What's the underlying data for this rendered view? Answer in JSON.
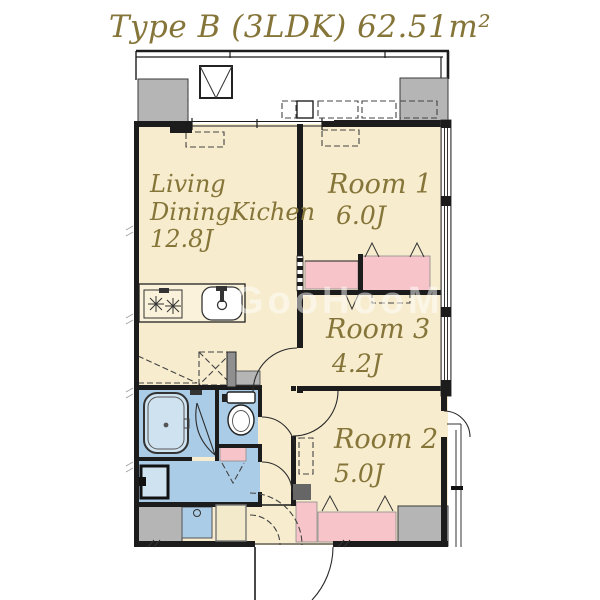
{
  "title": "Type B (3LDK) 62.51m²",
  "watermark": "GooHooM",
  "unit": {
    "ldk": {
      "line1": "Living",
      "line2": "DiningKichen",
      "area": "12.8J"
    },
    "room1": {
      "name": "Room 1",
      "area": "6.0J"
    },
    "room3": {
      "name": "Room 3",
      "area": "4.2J"
    },
    "room2": {
      "name": "Room 2",
      "area": "5.0J"
    }
  },
  "colors": {
    "floor": "#f7ecce",
    "closet": "#f7c5c9",
    "water": "#abcce6",
    "fixture": "#cfe2f0",
    "concrete": "#b5b5b5",
    "wall": "#1c1c1c",
    "label": "#857539",
    "watermark": "#ffffff"
  }
}
